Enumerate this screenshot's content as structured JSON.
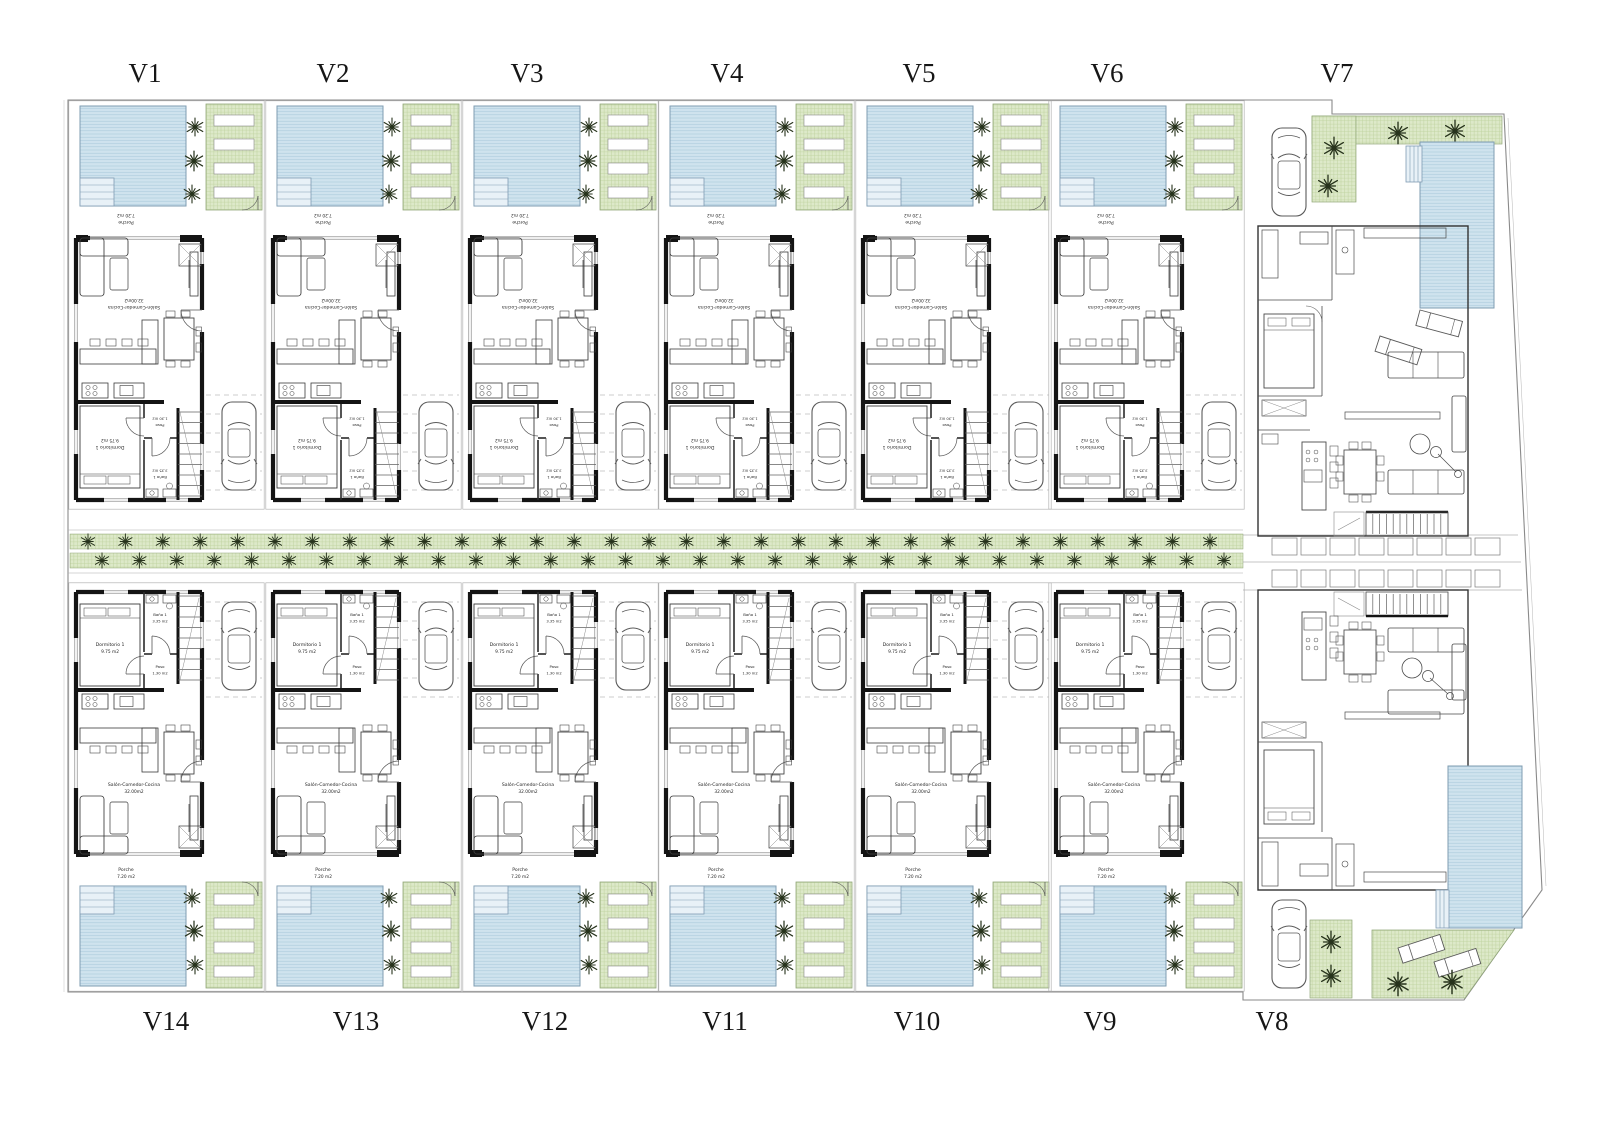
{
  "document": {
    "type": "architectural site plan",
    "description": "Row of 14 villas with pools, gardens, parking and central tree-lined street"
  },
  "colors": {
    "pool": "#cfe3ee",
    "pool_line": "#aac9db",
    "pool_border": "#7f9cb2",
    "pool_steps": "#e8f1f7",
    "garden": "#dde9c9",
    "garden_line": "#c0d3a0",
    "garden_border": "#93a87b",
    "wall": "#141414",
    "partition": "#2a2a2a",
    "line": "#4a4a4a",
    "light": "#9a9a9a",
    "tree": "#27331c",
    "paper": "#ffffff"
  },
  "rooms": {
    "porche": {
      "label": "Porche",
      "area": "7.20 m2"
    },
    "salon": {
      "label": "Salón-Comedor-Cocina",
      "area": "32.00m2"
    },
    "dormitorio": {
      "label": "Dormitorio 1",
      "area": "9.75 m2"
    },
    "bano": {
      "label": "Baño 1",
      "area": "3.35 m2"
    },
    "paso": {
      "label": "Paso",
      "area": "1.30 m2"
    }
  },
  "top_labels": [
    "V1",
    "V2",
    "V3",
    "V4",
    "V5",
    "V6",
    "V7"
  ],
  "bottom_labels": [
    "V14",
    "V13",
    "V12",
    "V11",
    "V10",
    "V9",
    "V8"
  ],
  "units": {
    "terraced_top": [
      "V1",
      "V2",
      "V3",
      "V4",
      "V5",
      "V6"
    ],
    "terraced_bottom": [
      "V14",
      "V13",
      "V12",
      "V11",
      "V10",
      "V9"
    ],
    "detached_villas": [
      "V7",
      "V8"
    ]
  },
  "symbols": {
    "tree": "palm-tree",
    "vehicle": "car",
    "lounger": "sun-lounger",
    "water": "swimming-pool",
    "planting": "garden-bed",
    "stairs": "staircase"
  }
}
